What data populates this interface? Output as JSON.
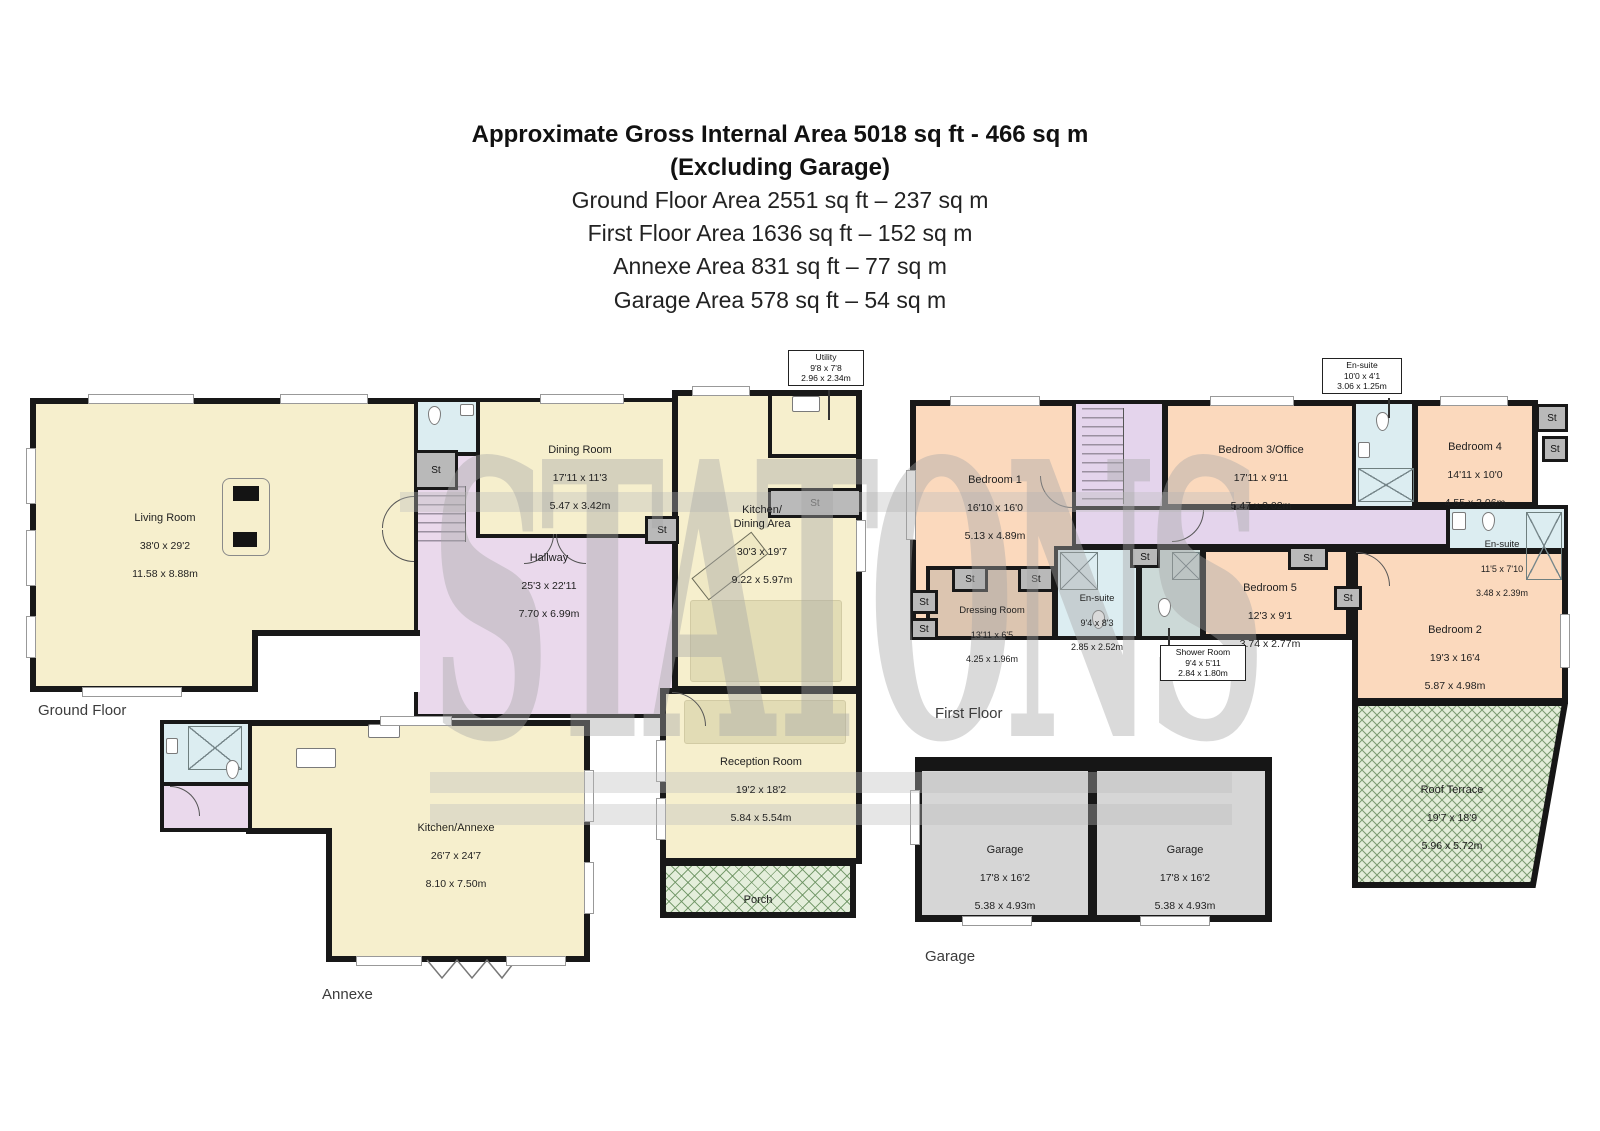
{
  "title": {
    "line1": "Approximate Gross Internal Area 5018 sq ft - 466 sq m",
    "line2": "(Excluding Garage)",
    "line3": "Ground Floor Area 2551 sq ft – 237 sq m",
    "line4": "First Floor Area 1636 sq ft – 152 sq m",
    "line5": "Annexe Area 831 sq ft – 77 sq m",
    "line6": "Garage Area 578 sq ft – 54 sq m"
  },
  "captions": {
    "ground_floor": "Ground Floor",
    "first_floor": "First Floor",
    "annexe": "Annexe",
    "garage": "Garage"
  },
  "watermark": "STATONS",
  "labels": {
    "storage": "St"
  },
  "rooms": {
    "living_room": {
      "name": "Living Room",
      "ft": "38'0 x 29'2",
      "m": "11.58 x 8.88m"
    },
    "dining_room": {
      "name": "Dining Room",
      "ft": "17'11 x 11'3",
      "m": "5.47 x 3.42m"
    },
    "hallway": {
      "name": "Hallway",
      "ft": "25'3 x 22'11",
      "m": "7.70 x 6.99m"
    },
    "kitchen_dining": {
      "name": "Kitchen/\nDining Area",
      "ft": "30'3 x 19'7",
      "m": "9.22 x 5.97m"
    },
    "utility": {
      "name": "Utility",
      "ft": "9'8 x 7'8",
      "m": "2.96 x 2.34m"
    },
    "reception_room": {
      "name": "Reception Room",
      "ft": "19'2 x 18'2",
      "m": "5.84 x 5.54m"
    },
    "porch": {
      "name": "Porch"
    },
    "kitchen_annexe": {
      "name": "Kitchen/Annexe",
      "ft": "26'7 x 24'7",
      "m": "8.10 x 7.50m"
    },
    "bedroom_1": {
      "name": "Bedroom 1",
      "ft": "16'10 x 16'0",
      "m": "5.13 x 4.89m"
    },
    "bedroom_2": {
      "name": "Bedroom 2",
      "ft": "19'3 x 16'4",
      "m": "5.87 x 4.98m"
    },
    "bedroom_3": {
      "name": "Bedroom 3/Office",
      "ft": "17'11 x 9'11",
      "m": "5.47 x 3.02m"
    },
    "bedroom_4": {
      "name": "Bedroom 4",
      "ft": "14'11 x 10'0",
      "m": "4.55 x 3.06m"
    },
    "bedroom_5": {
      "name": "Bedroom 5",
      "ft": "12'3 x 9'1",
      "m": "3.74 x 2.77m"
    },
    "dressing_room": {
      "name": "Dressing Room",
      "ft": "13'11 x 6'5",
      "m": "4.25 x 1.96m"
    },
    "ensuite_top": {
      "name": "En-suite",
      "ft": "10'0 x 4'1",
      "m": "3.06 x 1.25m"
    },
    "ensuite_mid": {
      "name": "En-suite",
      "ft": "9'4 x 8'3",
      "m": "2.85 x 2.52m"
    },
    "ensuite_right": {
      "name": "En-suite",
      "ft": "11'5 x 7'10",
      "m": "3.48 x 2.39m"
    },
    "shower_room": {
      "name": "Shower Room",
      "ft": "9'4 x 5'11",
      "m": "2.84 x 1.80m"
    },
    "roof_terrace": {
      "name": "Roof Terrace",
      "ft": "19'7 x 18'9",
      "m": "5.96 x 5.72m"
    },
    "garage_left": {
      "name": "Garage",
      "ft": "17'8 x 16'2",
      "m": "5.38 x 4.93m"
    },
    "garage_right": {
      "name": "Garage",
      "ft": "17'8 x 16'2",
      "m": "5.38 x 4.93m"
    }
  },
  "colors": {
    "cream": "#f6efcd",
    "bedroom_peach": "#fbd9bd",
    "hallway_pink": "#ead9ec",
    "corridor_lavender": "#e4d4ec",
    "bathroom_blue": "#dcedf1",
    "shower_gray": "#ccd9d7",
    "dressing_tan": "#dcc5b0",
    "terrace_green": "#e2ecd8",
    "garage_gray": "#d6d6d6",
    "wall": "#181818",
    "storage_gray": "#b9b9b9"
  }
}
